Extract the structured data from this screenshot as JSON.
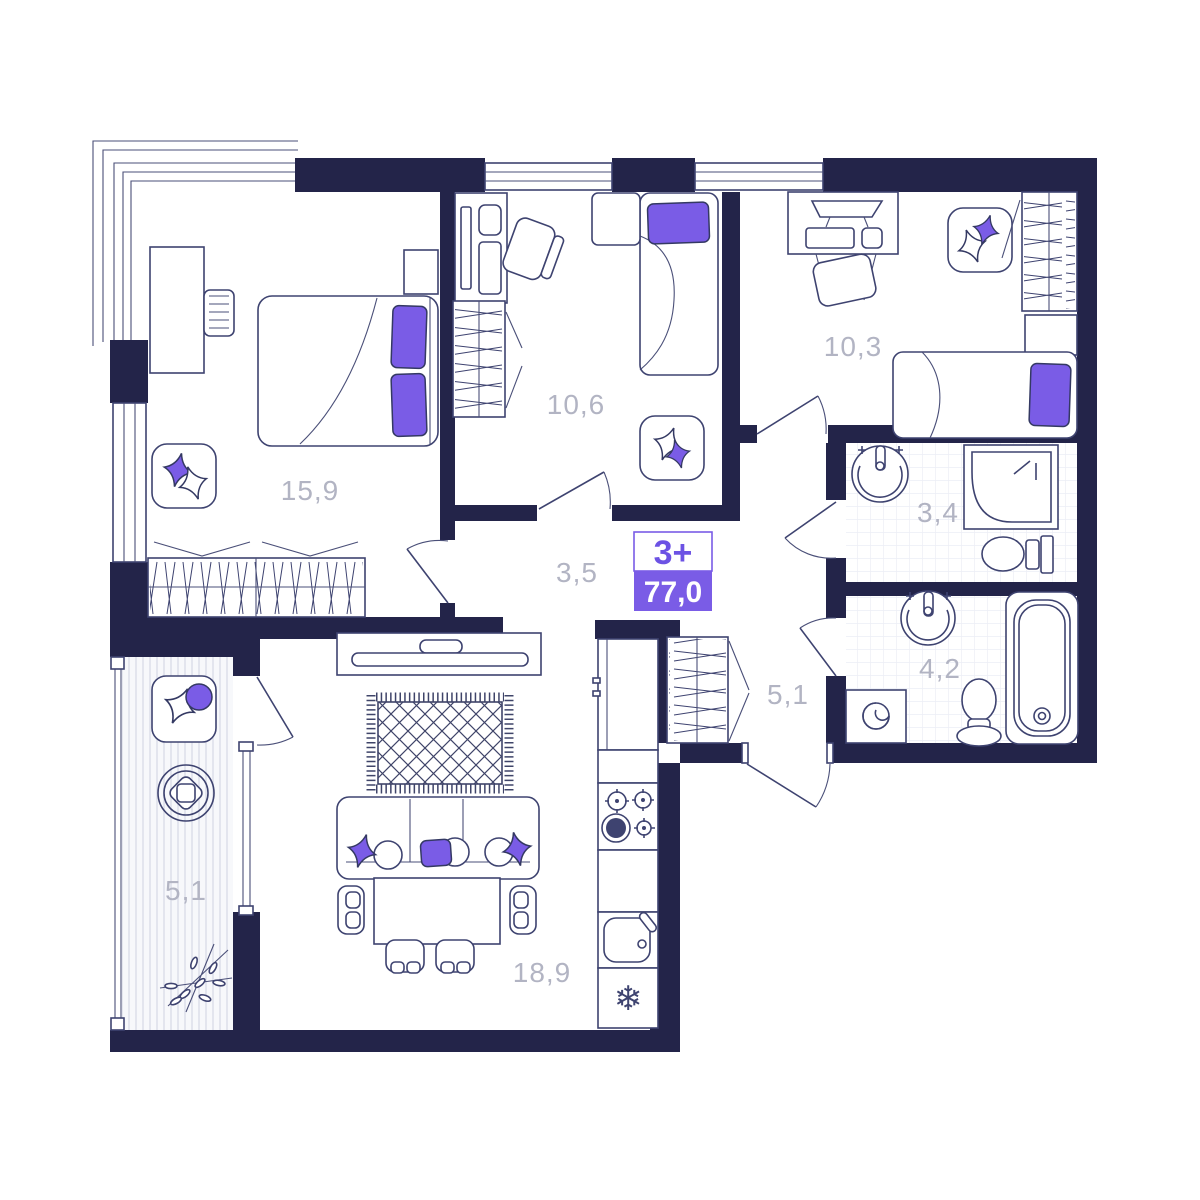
{
  "plan": {
    "badge": {
      "rooms_label": "3+",
      "area_value": "77,0"
    },
    "rooms": {
      "bedroom": {
        "area": "15,9"
      },
      "child_room_1": {
        "area": "10,6"
      },
      "child_room_2": {
        "area": "10,3"
      },
      "corridor": {
        "area": "3,5"
      },
      "shower_room": {
        "area": "3,4"
      },
      "bathroom": {
        "area": "4,2"
      },
      "hallway": {
        "area": "5,1"
      },
      "balcony": {
        "area": "5,1"
      },
      "kitchen_living": {
        "area": "18,9"
      }
    },
    "icons": {
      "freezer_snowflake": "❄"
    },
    "colors": {
      "wall": "#232449",
      "accent": "#7a5ce6",
      "badge_text": "#6c52e4",
      "label": "#b2b4c3",
      "furniture_line": "#3e4370"
    }
  }
}
